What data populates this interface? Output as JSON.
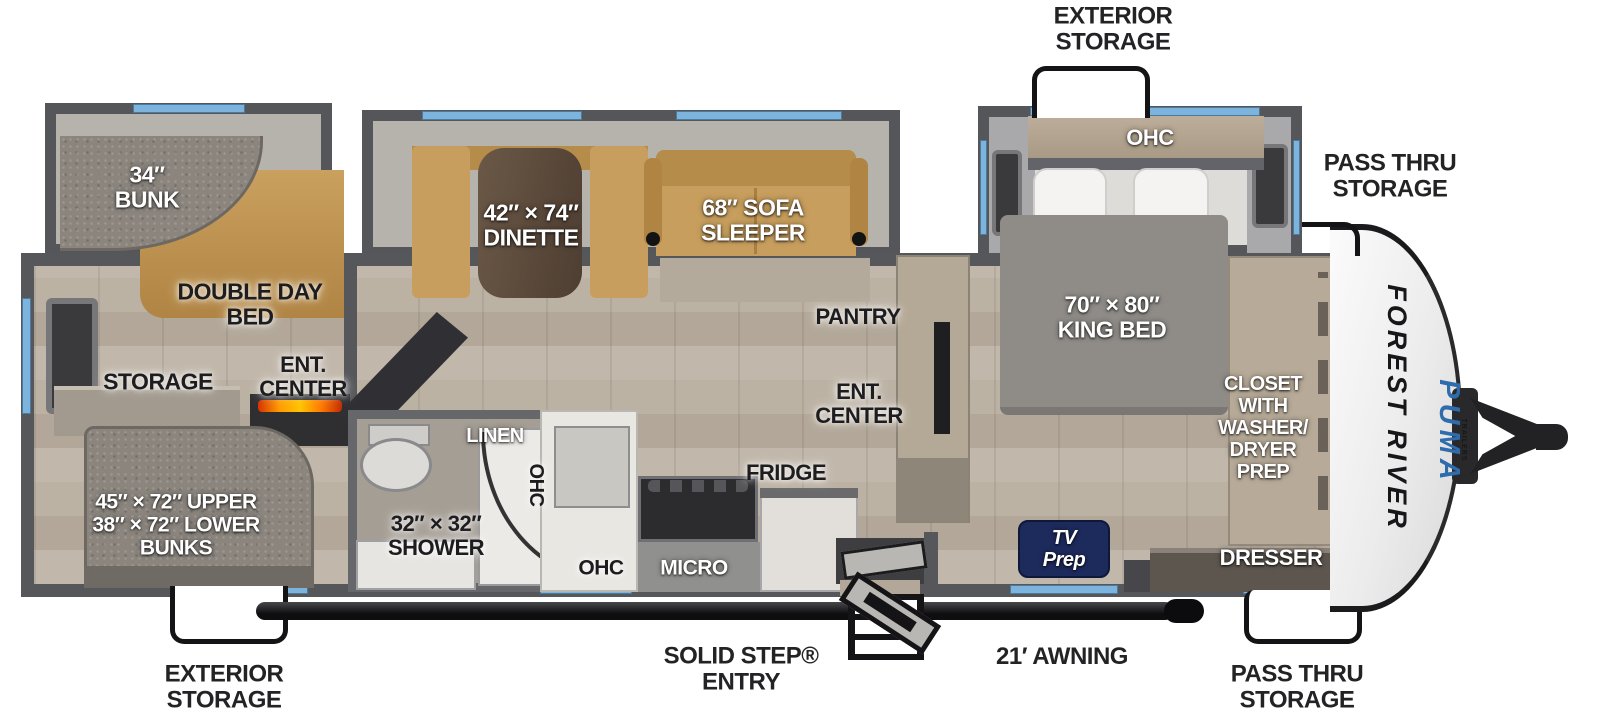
{
  "brand": {
    "maker": "FOREST RIVER",
    "model": "PUMA",
    "model_sub": "TRAILERS"
  },
  "colors": {
    "window_blue": "#7db4dd",
    "wall_gray": "#56575b",
    "tv_prep_navy": "#1d2a5c",
    "puma_blue": "#2e6cab",
    "sofa_tan": "#c79e5d"
  },
  "callouts": {
    "top_exterior_storage": "EXTERIOR\nSTORAGE",
    "front_top_pass_thru": "PASS THRU\nSTORAGE",
    "bottom_exterior_storage": "EXTERIOR\nSTORAGE",
    "solid_step_entry": "SOLID STEP®\nENTRY",
    "awning": "21′ AWNING",
    "front_bottom_pass_thru": "PASS THRU\nSTORAGE"
  },
  "rooms": {
    "bunk_34": "34″\nBUNK",
    "double_day_bed": "DOUBLE DAY\nBED",
    "storage": "STORAGE",
    "ent_center_rear": "ENT.\nCENTER",
    "rear_bunks": "45″ × 72″ UPPER\n38″ × 72″ LOWER\nBUNKS",
    "shower": "32″ × 32″\nSHOWER",
    "linen": "LINEN",
    "ohc_bath_wall": "OHC",
    "ohc_kitchen": "OHC",
    "micro": "MICRO",
    "fridge": "FRIDGE",
    "dinette": "42″ × 74″\nDINETTE",
    "sofa_sleeper": "68″ SOFA\nSLEEPER",
    "pantry": "PANTRY",
    "ent_center_main": "ENT.\nCENTER",
    "king_bed": "70″ × 80″\nKING BED",
    "ohc_bedroom": "OHC",
    "closet": "CLOSET\nWITH\nWASHER/\nDRYER\nPREP",
    "dresser": "DRESSER",
    "tv_prep": "TV\nPrep"
  }
}
